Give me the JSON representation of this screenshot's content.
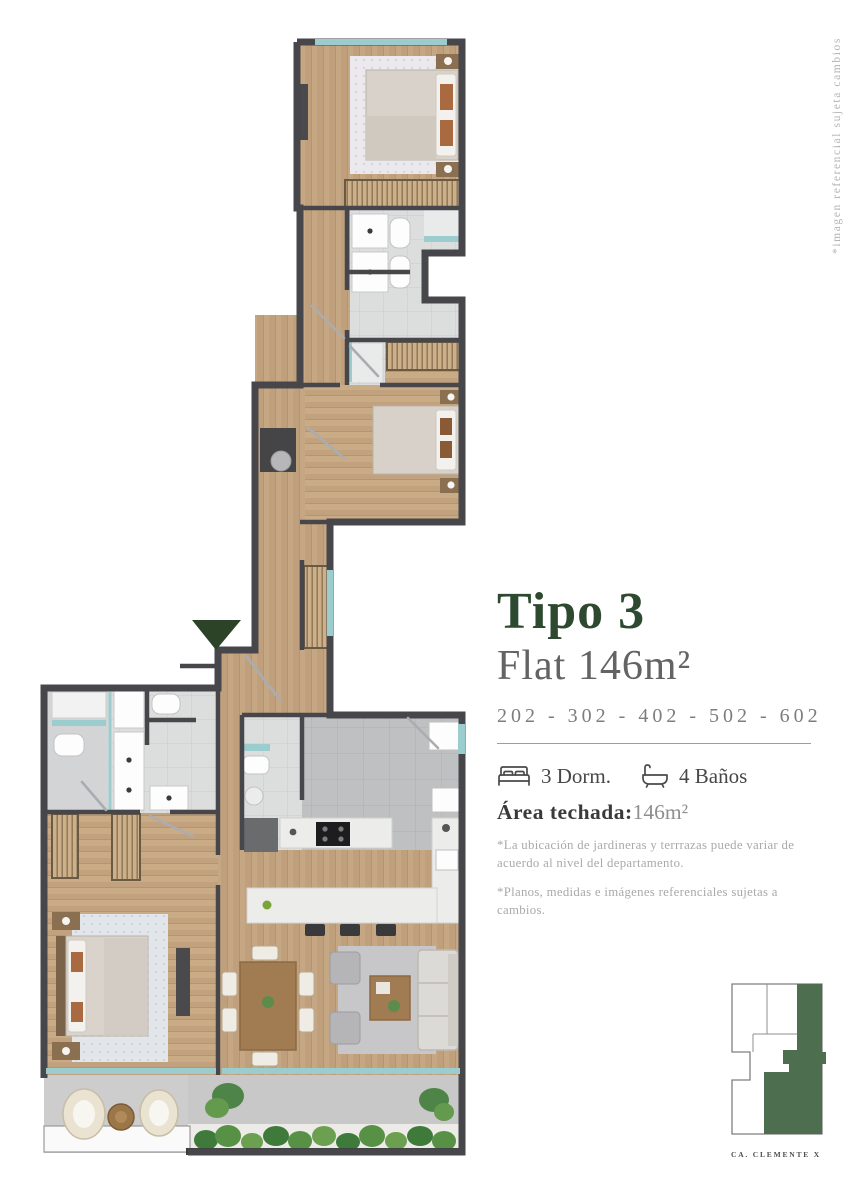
{
  "info": {
    "title": "Tipo 3",
    "subtitle": "Flat 146m²",
    "units": "202 - 302 - 402 - 502 - 602",
    "features": [
      {
        "icon": "bed-icon",
        "label": "3 Dorm."
      },
      {
        "icon": "bath-icon",
        "label": "4 Baños"
      }
    ],
    "area_label": "Área techada:",
    "area_value": "146m²",
    "disclaimers": [
      "*La ubicación de jardineras y terrrazas puede variar de acuerdo al nivel del departamento.",
      "*Planos, medidas e imágenes referenciales sujetas a cambios."
    ]
  },
  "side_note": "*imagen referencial sujeta cambios",
  "keyplan": {
    "caption": "CA. CLEMENTE X"
  },
  "colors": {
    "brand_green": "#2d4a30",
    "keyplan_green": "#4e6e50",
    "entrance_green": "#2c4327",
    "wall": "#47474b",
    "wood": "#c6a783",
    "glass": "#9ccdce"
  }
}
